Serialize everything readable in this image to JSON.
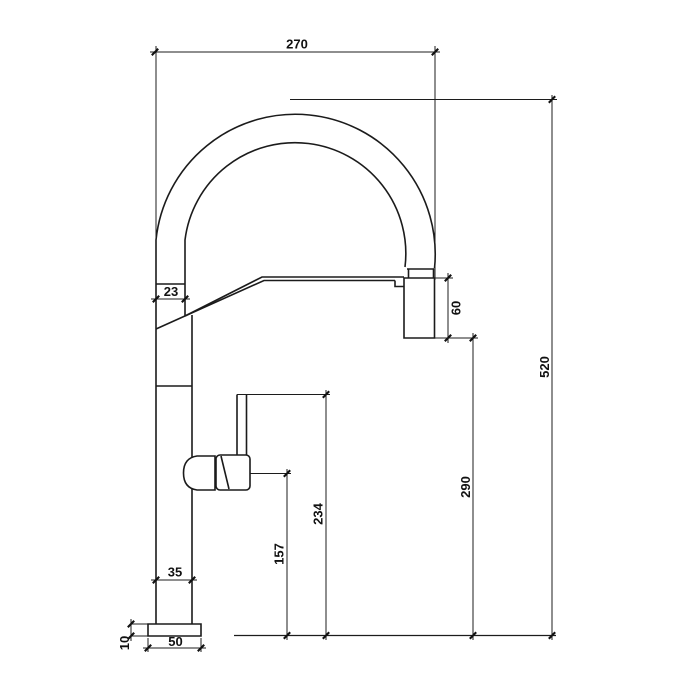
{
  "drawing": {
    "title": "Kitchen faucet dimensional drawing - side elevation",
    "background_color": "#ffffff",
    "line_color": "#1b1b1b",
    "dimensions": {
      "spout_reach": "270",
      "spout_tube_width": "23",
      "spray_head_height": "60",
      "overall_height": "520",
      "outlet_height": "290",
      "handle_top_height": "234",
      "handle_pivot_height": "157",
      "body_width": "35",
      "base_width": "50",
      "base_plate_height": "10"
    }
  }
}
